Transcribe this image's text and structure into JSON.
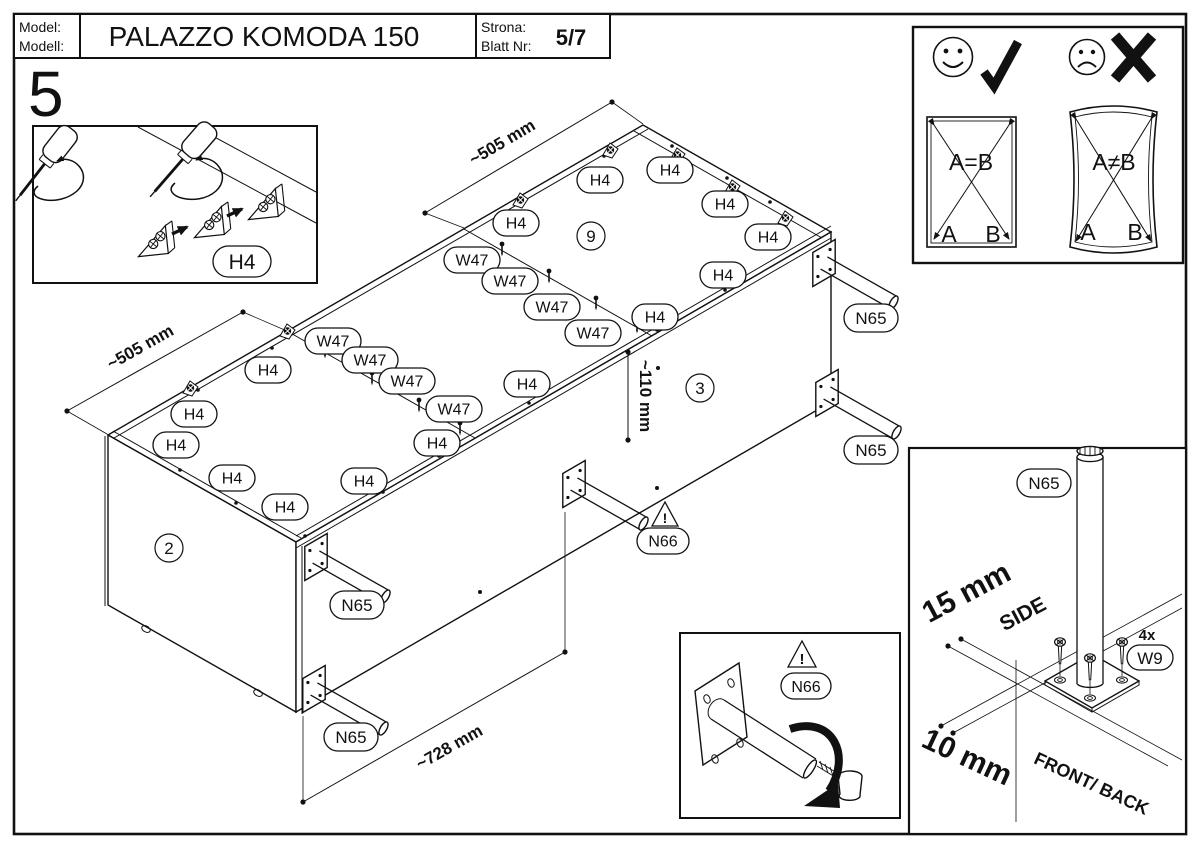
{
  "header": {
    "model_label_1": "Model:",
    "model_label_2": "Modell:",
    "title": "PALAZZO KOMODA 150",
    "page_label_1": "Strona:",
    "page_label_2": "Blatt Nr:",
    "page_value": "5/7"
  },
  "step_number": "5",
  "diagram": {
    "dim_depth_top": "~505 mm",
    "dim_depth_left": "~505 mm",
    "dim_leg_inset": "~110 mm",
    "dim_leg_spacing": "~728 mm",
    "circled_parts": [
      {
        "text": "9",
        "x": 591,
        "y": 236
      },
      {
        "text": "3",
        "x": 700,
        "y": 388
      },
      {
        "text": "2",
        "x": 169,
        "y": 548
      }
    ],
    "h4_labels": [
      {
        "text": "H4",
        "x": 600,
        "y": 180
      },
      {
        "text": "H4",
        "x": 670,
        "y": 170
      },
      {
        "text": "H4",
        "x": 725,
        "y": 204
      },
      {
        "text": "H4",
        "x": 768,
        "y": 237
      },
      {
        "text": "H4",
        "x": 723,
        "y": 275
      },
      {
        "text": "H4",
        "x": 655,
        "y": 317
      },
      {
        "text": "H4",
        "x": 516,
        "y": 223
      },
      {
        "text": "H4",
        "x": 268,
        "y": 370
      },
      {
        "text": "H4",
        "x": 194,
        "y": 414
      },
      {
        "text": "H4",
        "x": 176,
        "y": 445
      },
      {
        "text": "H4",
        "x": 232,
        "y": 478
      },
      {
        "text": "H4",
        "x": 285,
        "y": 507
      },
      {
        "text": "H4",
        "x": 364,
        "y": 481
      },
      {
        "text": "H4",
        "x": 437,
        "y": 443
      },
      {
        "text": "H4",
        "x": 527,
        "y": 384
      }
    ],
    "w47_labels": [
      {
        "text": "W47",
        "x": 333,
        "y": 341
      },
      {
        "text": "W47",
        "x": 370,
        "y": 360
      },
      {
        "text": "W47",
        "x": 407,
        "y": 381
      },
      {
        "text": "W47",
        "x": 454,
        "y": 409
      },
      {
        "text": "W47",
        "x": 472,
        "y": 260
      },
      {
        "text": "W47",
        "x": 510,
        "y": 281
      },
      {
        "text": "W47",
        "x": 552,
        "y": 307
      },
      {
        "text": "W47",
        "x": 593,
        "y": 333
      }
    ],
    "n65_labels": [
      {
        "text": "N65",
        "x": 871,
        "y": 318
      },
      {
        "text": "N65",
        "x": 871,
        "y": 450
      },
      {
        "text": "N65",
        "x": 357,
        "y": 605
      },
      {
        "text": "N65",
        "x": 351,
        "y": 737
      }
    ],
    "n66_labels": [
      {
        "text": "N66",
        "x": 663,
        "y": 541
      }
    ]
  },
  "inset_corner_blocks": {
    "h4_label": "H4"
  },
  "inset_diagonal_check": {
    "ok_formula": "A=B",
    "bad_formula": "A≠B",
    "corner_a": "A",
    "corner_b": "B"
  },
  "inset_adjustable_foot": {
    "n66_label": "N66"
  },
  "inset_leg_mounting": {
    "n65_label": "N65",
    "quantity": "4x",
    "w9_label": "W9",
    "side_offset": "15 mm",
    "side_label": "SIDE",
    "front_offset": "10 mm",
    "front_label": "FRONT/ BACK"
  }
}
